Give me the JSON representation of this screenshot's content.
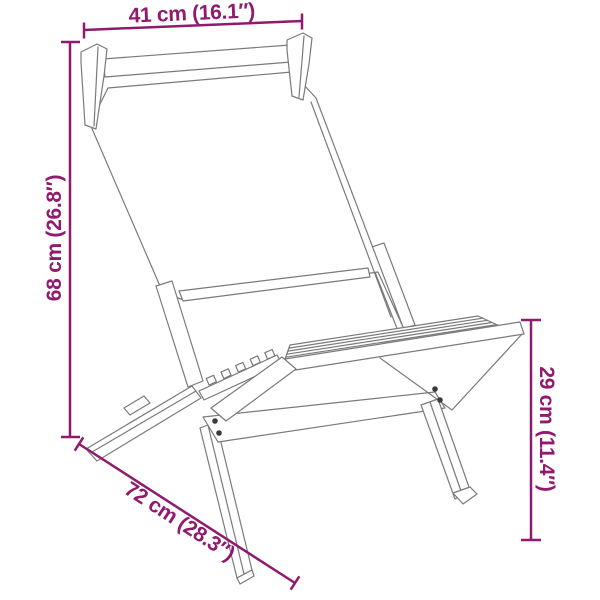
{
  "colors": {
    "dimension_accent": "#901A6E",
    "drawing_line": "#7a7a7a",
    "screw_dot": "#3a3a3a",
    "background": "#ffffff"
  },
  "figure": {
    "name": "folding-chair-line-drawing"
  },
  "dimensions": {
    "width_top": {
      "label": "41 cm (16.1″)"
    },
    "height_left": {
      "label": "68 cm (26.8″)"
    },
    "depth_bottom": {
      "label": "72 cm (28.3″)"
    },
    "seat_height_right": {
      "label": "29 cm (11.4″)"
    }
  }
}
